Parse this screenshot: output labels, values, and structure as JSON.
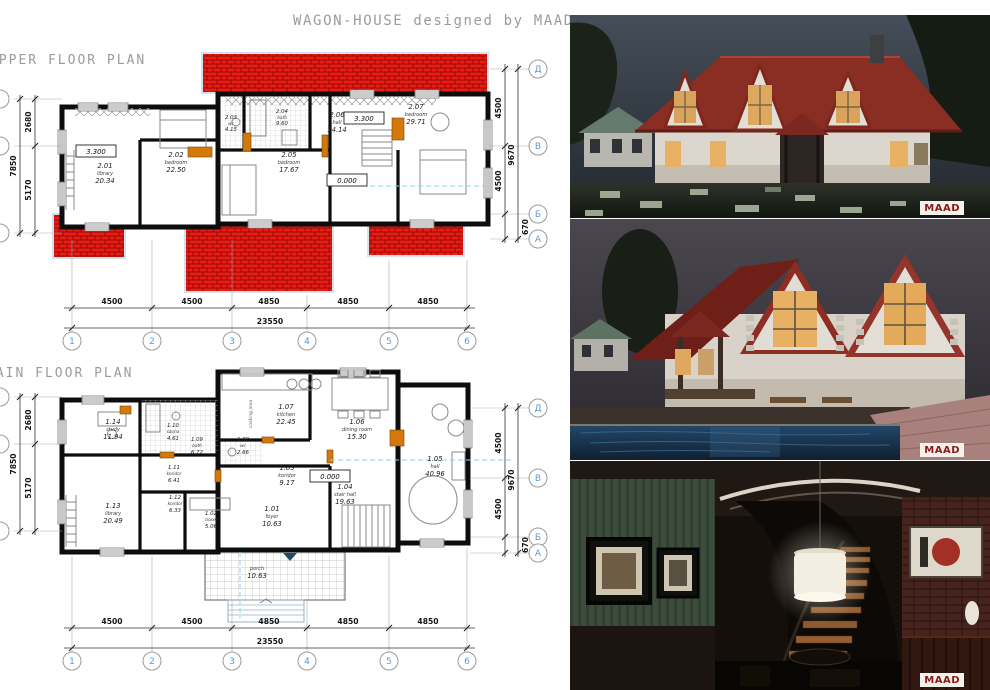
{
  "title": "WAGON-HOUSE designed by MAAD",
  "upper_plan": {
    "title": "UPPER FLOOR PLAN",
    "rooms": [
      {
        "number": "2.01",
        "name": "library",
        "area": "20.34"
      },
      {
        "number": "2.02",
        "name": "bedroom",
        "area": "22.50"
      },
      {
        "number": "2.03",
        "name": "wc",
        "area": "4.15"
      },
      {
        "number": "2.04",
        "name": "bath",
        "area": "9.60"
      },
      {
        "number": "2.05",
        "name": "bedroom",
        "area": "17.67"
      },
      {
        "number": "2.06",
        "name": "hall",
        "area": "14.14"
      },
      {
        "number": "2.07",
        "name": "bedroom",
        "area": "29.71"
      }
    ],
    "marks": [
      "3.300",
      "3.300",
      "0.000"
    ],
    "dims_bottom": [
      "4500",
      "4500",
      "4850",
      "4850",
      "4850"
    ],
    "dim_total": "23550",
    "dims_left": [
      "2680",
      "7850",
      "5170"
    ],
    "dims_right": [
      "4500",
      "9670",
      "4500",
      "670"
    ],
    "grid_cols": [
      "1",
      "2",
      "3",
      "4",
      "5",
      "6"
    ],
    "grid_rows": [
      "Д",
      "В",
      "Б",
      "А"
    ]
  },
  "main_plan": {
    "title": "MAIN FLOOR PLAN",
    "rooms": [
      {
        "number": "1.01",
        "name": "foyer",
        "area": "10.63"
      },
      {
        "number": "1.02",
        "name": "closet",
        "area": "5.06"
      },
      {
        "number": "1.03",
        "name": "koridor",
        "area": "9.17"
      },
      {
        "number": "1.04",
        "name": "stair hall",
        "area": "19.63"
      },
      {
        "number": "1.05",
        "name": "hall",
        "area": "40.96"
      },
      {
        "number": "1.06",
        "name": "dining room",
        "area": "15.30"
      },
      {
        "number": "1.07",
        "name": "kitchen",
        "area": "22.45"
      },
      {
        "number": "1.08",
        "name": "wc",
        "area": "2.66"
      },
      {
        "number": "1.09",
        "name": "bath",
        "area": "6.72"
      },
      {
        "number": "1.10",
        "name": "sauna",
        "area": "4.61"
      },
      {
        "number": "1.11",
        "name": "koridor",
        "area": "6.41"
      },
      {
        "number": "1.12",
        "name": "koridor",
        "area": "6.33"
      },
      {
        "number": "1.13",
        "name": "library",
        "area": "20.49"
      },
      {
        "number": "1.14",
        "name": "study",
        "area": "11.94"
      }
    ],
    "porch": {
      "name": "porch",
      "area": "10.63"
    },
    "annotations": {
      "cooking_area": "cooking area"
    },
    "marks": [
      "0.000"
    ],
    "dims_bottom": [
      "4500",
      "4500",
      "4850",
      "4850",
      "4850"
    ],
    "dim_total": "23550",
    "dims_left": [
      "2680",
      "7850",
      "5170"
    ],
    "dims_right": [
      "4500",
      "9670",
      "4500",
      "670"
    ],
    "grid_cols": [
      "1",
      "2",
      "3",
      "4",
      "5",
      "6"
    ],
    "grid_rows": [
      "Д",
      "В",
      "Б",
      "А"
    ]
  },
  "renders": [
    {
      "logo": "MAAD"
    },
    {
      "logo": "MAAD"
    },
    {
      "logo": "MAAD"
    }
  ],
  "colors": {
    "roof_red": "#ec1c14",
    "accent_orange": "#d4780a",
    "grid_blue": "#5b9bd5",
    "logo_red": "#8c1a14"
  }
}
